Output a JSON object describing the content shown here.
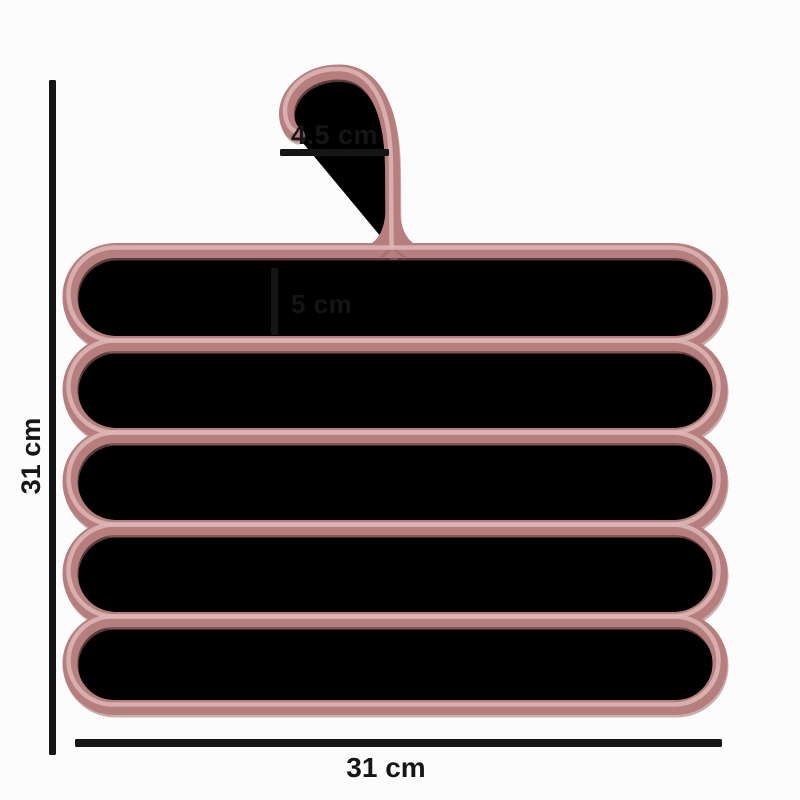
{
  "product": {
    "kind": "multi-layer-pants-hanger-dimension-diagram",
    "layer_count": 5,
    "colors": {
      "rod": "#b77e7e",
      "rod_highlight": "#ddb7b7",
      "rod_shadow": "#a06c6c",
      "annotation": "#151515",
      "background": "#fcfcfc"
    }
  },
  "dimensions": {
    "hook_width": "4.5 cm",
    "layer_spacing": "5 cm",
    "total_height": "31 cm",
    "total_width": "31 cm"
  }
}
